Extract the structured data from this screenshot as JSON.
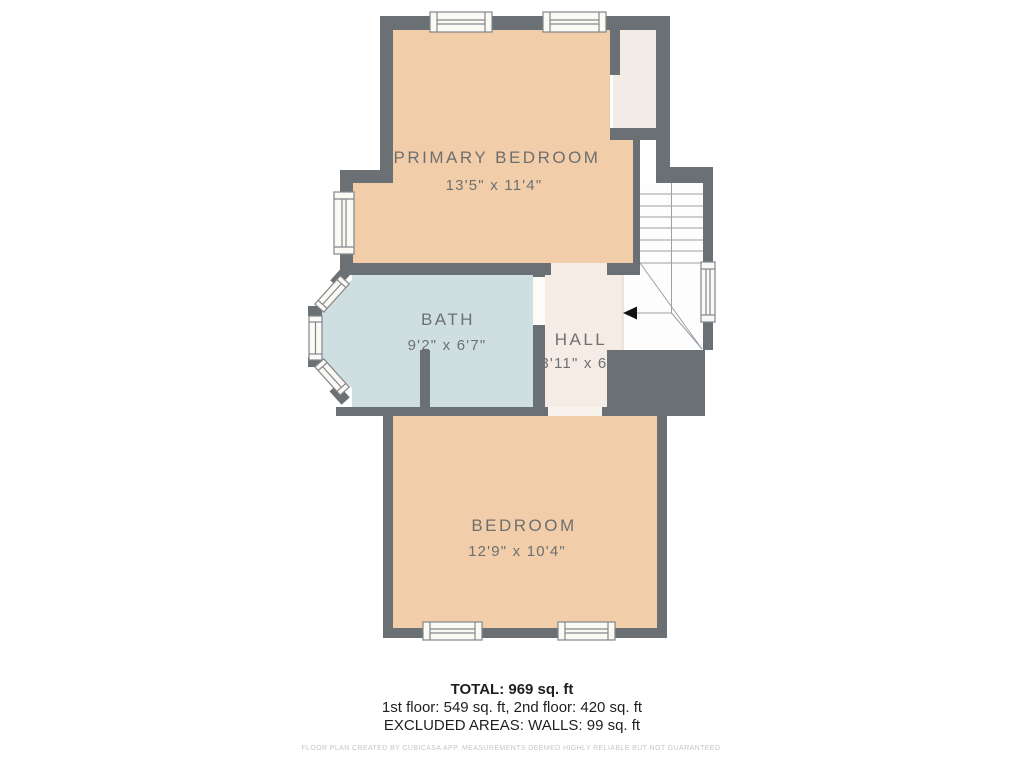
{
  "rooms": {
    "primary_bedroom": {
      "name": "PRIMARY BEDROOM",
      "dims": "13'5\" x 11'4\""
    },
    "bath": {
      "name": "BATH",
      "dims": "9'2\" x 6'7\""
    },
    "hall": {
      "name": "HALL",
      "dims": "3'11\" x 6'7\""
    },
    "bedroom": {
      "name": "BEDROOM",
      "dims": "12'9\" x 10'4\""
    }
  },
  "summary": {
    "total": "TOTAL: 969 sq. ft",
    "floors": "1st floor: 549 sq. ft, 2nd floor: 420 sq. ft",
    "excluded": "EXCLUDED AREAS: WALLS: 99 sq. ft"
  },
  "disclaimer": "FLOOR PLAN CREATED BY CUBICASA APP. MEASUREMENTS DEEMED HIGHLY RELIABLE BUT NOT GUARANTEED.",
  "colors": {
    "wall": "#6b7075",
    "room_warm": "#f2cda9",
    "room_bath": "#cfdfe1",
    "room_hall": "#f5ece5",
    "closet": "#f1ece6",
    "stairs": "#fdfdfd",
    "window_fill": "#fbf9f4",
    "label_text": "#6e706f",
    "footer_text": "#1f1f1f",
    "disclaimer_text": "#c9c6c1",
    "stair_arrow": "#111111"
  }
}
